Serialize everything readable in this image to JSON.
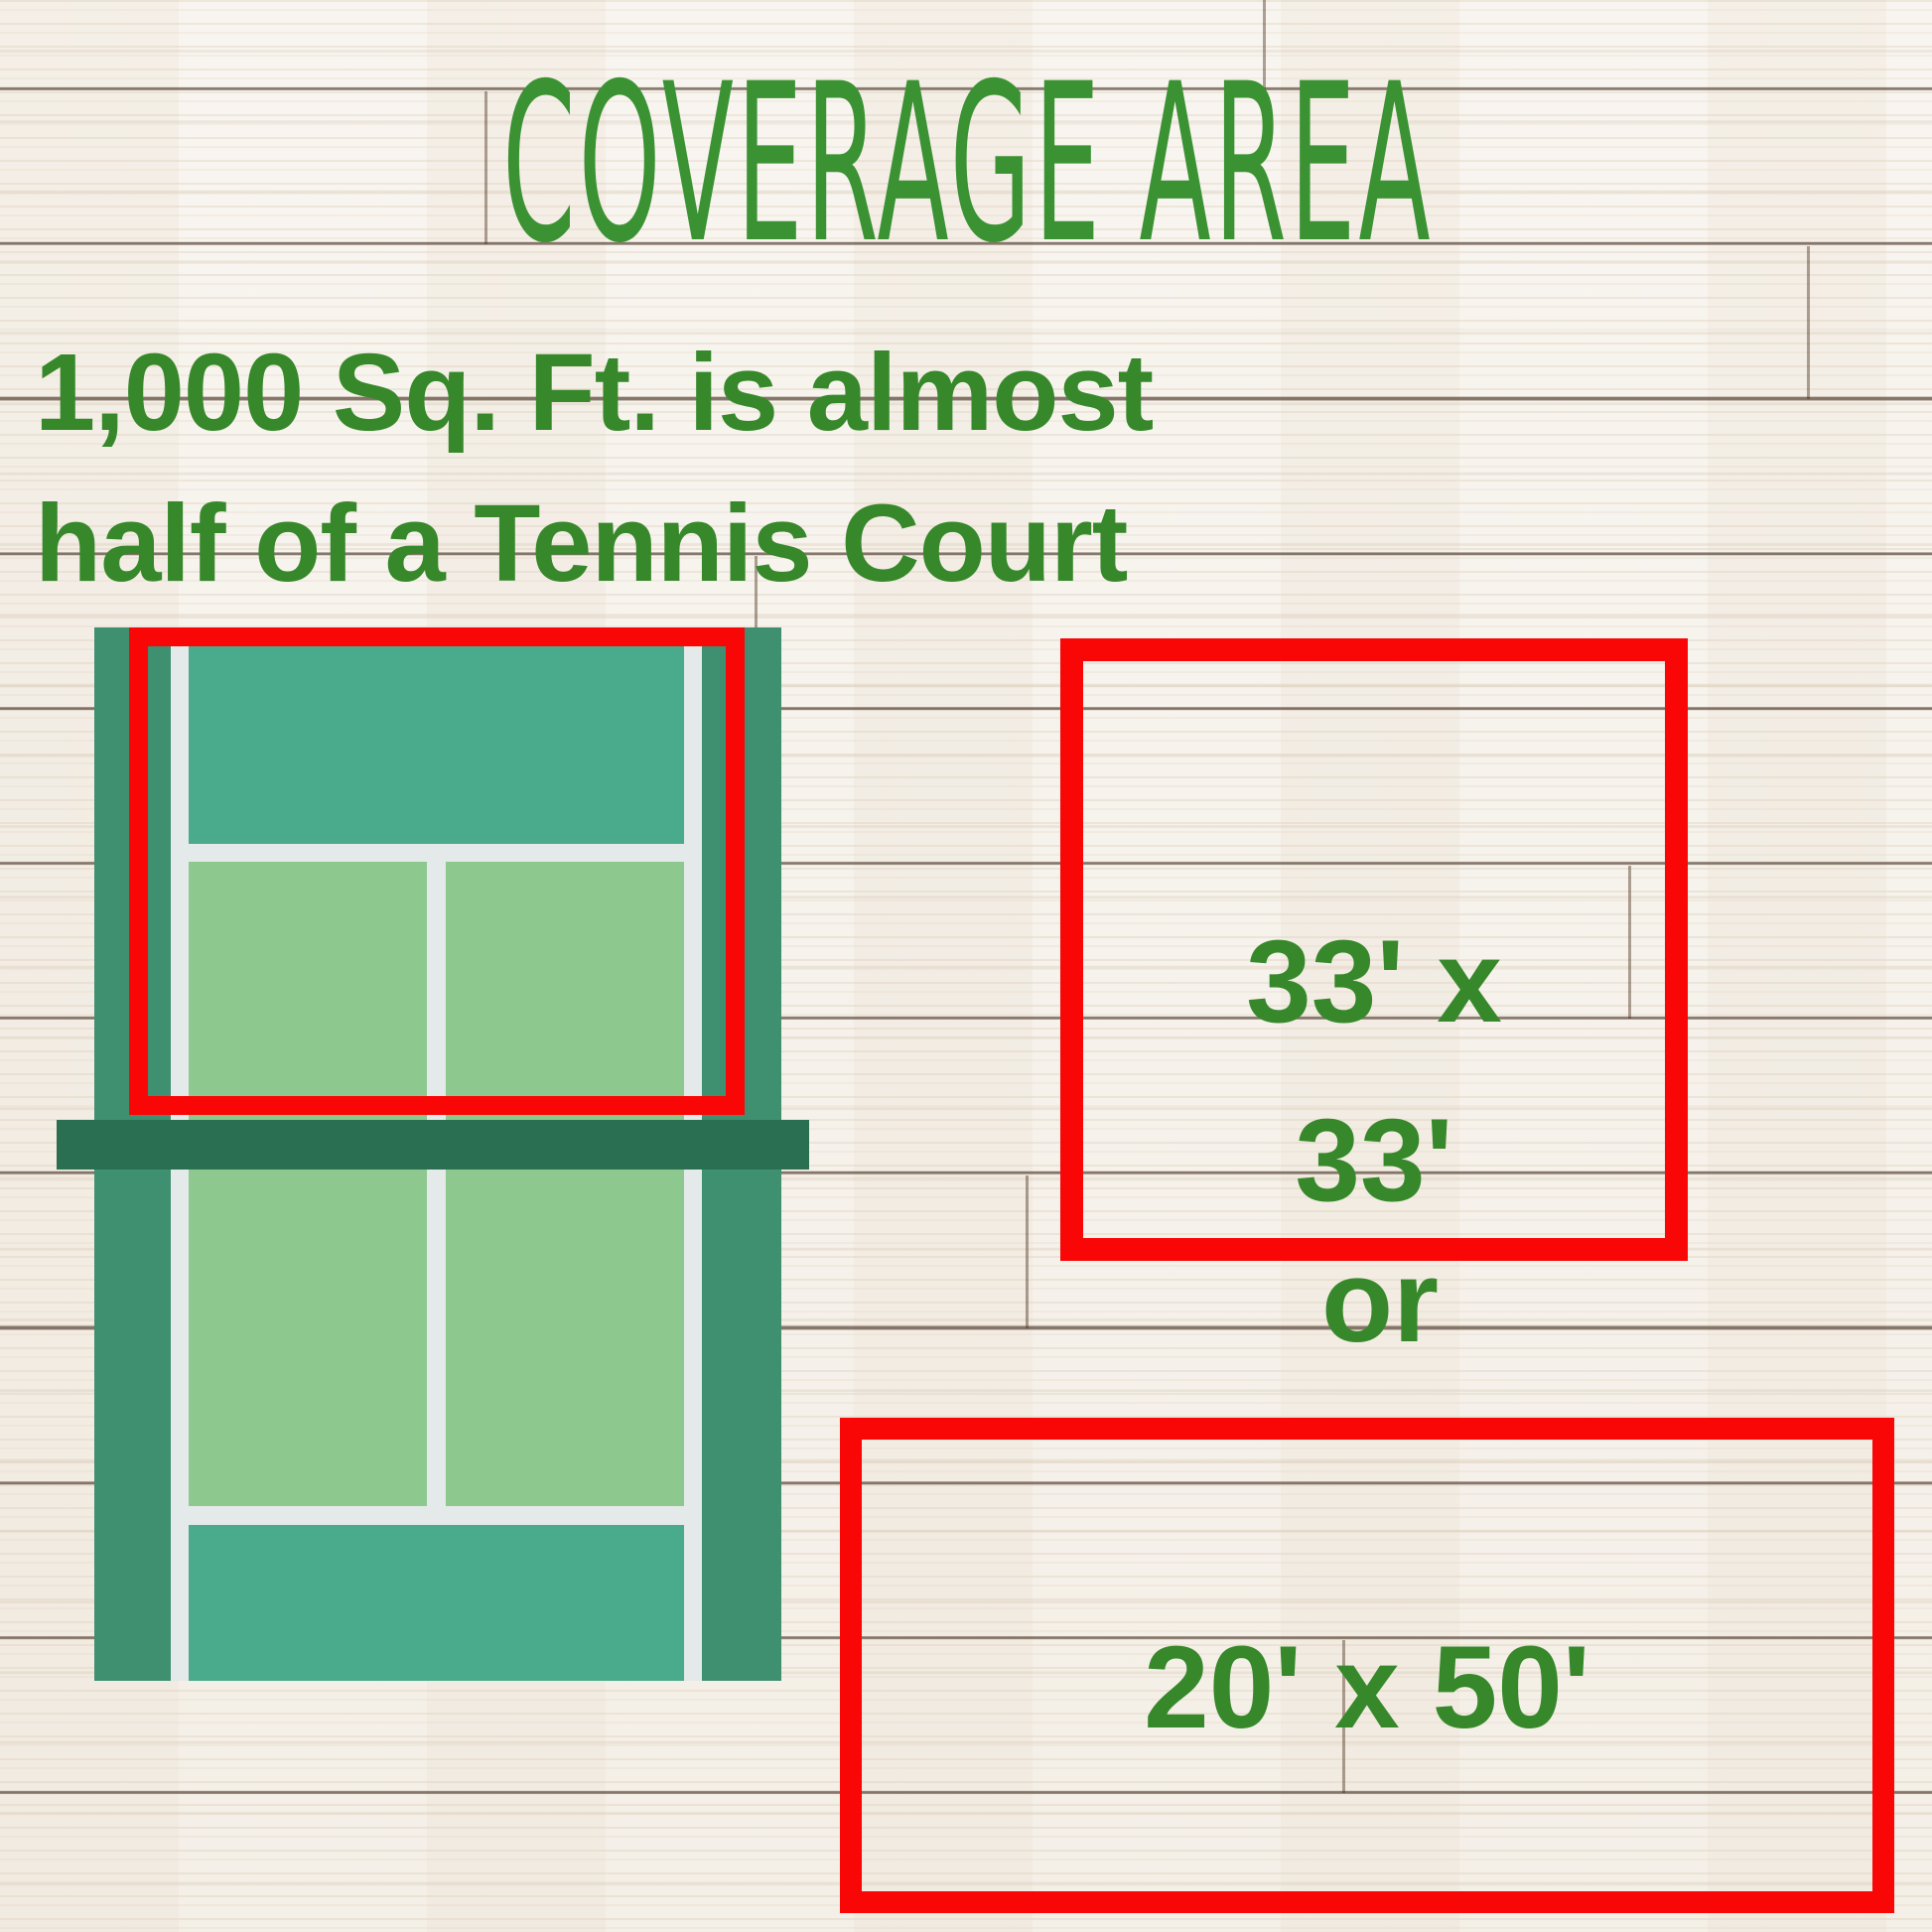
{
  "title": "COVERAGE AREA",
  "subtitle": {
    "line1": "1,000 Sq. Ft. is almost",
    "line2": "half of a Tennis Court"
  },
  "options": {
    "square": {
      "line1": "33' x",
      "line2": "33'"
    },
    "separator": "or",
    "rectangle": {
      "label": "20' x 50'"
    }
  },
  "colors": {
    "title-green": "#3b9233",
    "text-green": "#37882b",
    "outline-red": "#f90606",
    "court-margin": "#3f8f71",
    "court-surface": "#4aab8c",
    "service-box": "#8dc88e",
    "court-line": "#e4e9e9",
    "net": "#2a6f52"
  }
}
